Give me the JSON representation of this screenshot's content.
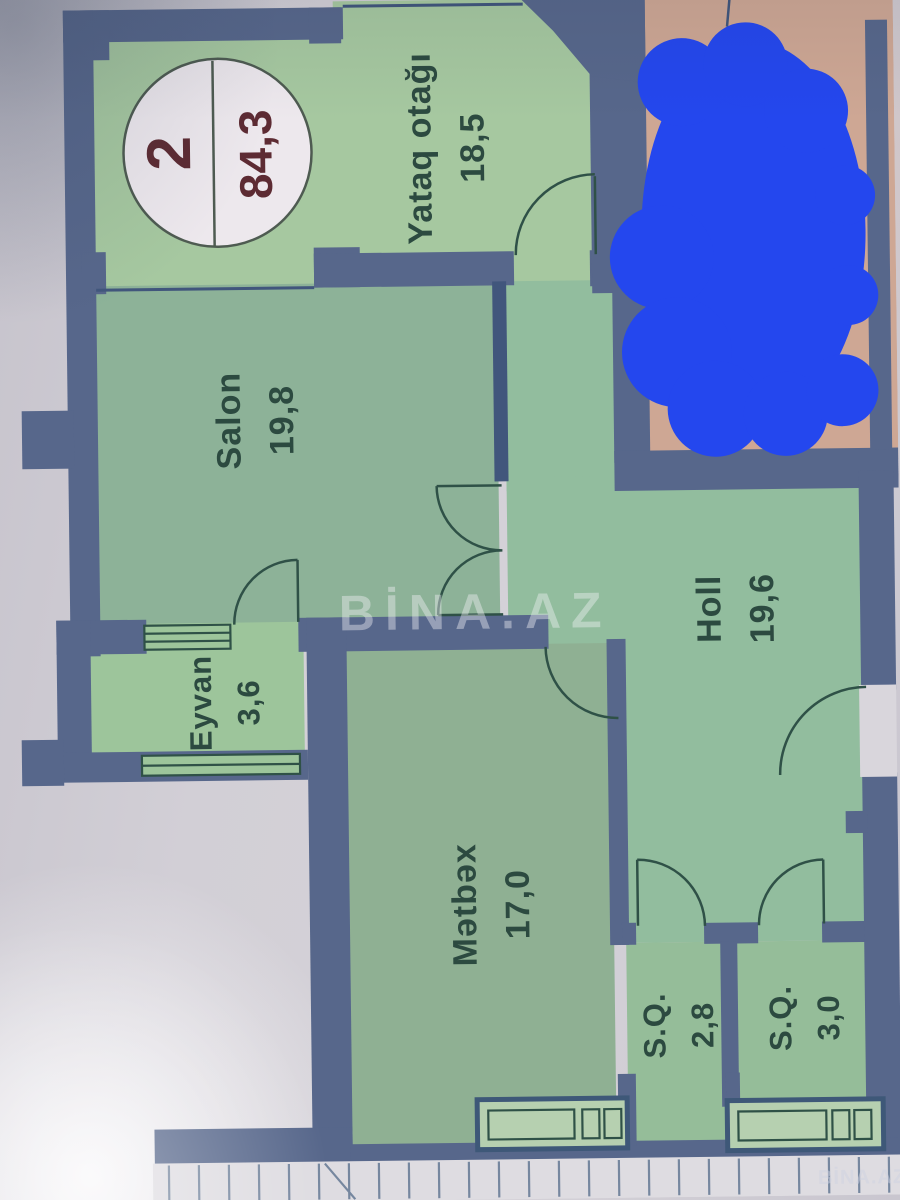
{
  "badge": {
    "room_count": "2",
    "total_area": "84,3"
  },
  "rooms": [
    {
      "name": "Yataq otağı",
      "area": "18,5"
    },
    {
      "name": "Salon",
      "area": "19,8"
    },
    {
      "name": "Eyvan",
      "area": "3,6"
    },
    {
      "name": "Holl",
      "area": "19,6"
    },
    {
      "name": "Mətbəx",
      "area": "17,0"
    },
    {
      "name": "S.Q.",
      "area": "2,8"
    },
    {
      "name": "S.Q.",
      "area": "3,0"
    }
  ],
  "watermarks": {
    "center": "BİNA.AZ",
    "corner": "BİNA.AZ"
  },
  "colors": {
    "wall": "#57678B",
    "wall_dark": "#41567C",
    "bedroom_green": "#A6C8A0",
    "salon_green": "#8DB298",
    "eyvan_green": "#9DC59B",
    "holl_green": "#92BD9E",
    "kitchen_green": "#8FB093",
    "sq_green": "#95BD99",
    "pane_green": "#B6D0B0",
    "neighbor_tan": "#CEA794",
    "scribble_blue": "#2447EE",
    "badge_bg": "#EDE8ED",
    "badge_text": "#5D2B33",
    "label_text": "#2C4A40",
    "door_line": "#2F5147",
    "hatch_line": "#76879F",
    "entry_gap": "#D9D6DC",
    "paper": "#CFCCD4"
  }
}
